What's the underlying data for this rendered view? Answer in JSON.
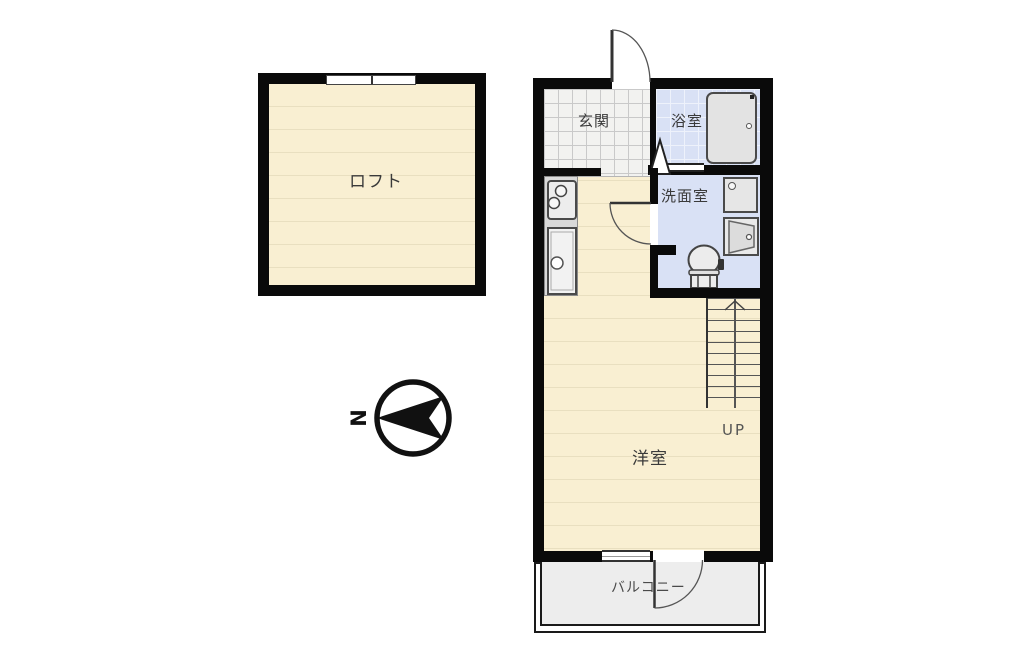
{
  "plan": {
    "title": "1R loft apartment floor plan",
    "compass": {
      "north_label": "N"
    },
    "labels": {
      "loft": "ロフト",
      "entrance": "玄関",
      "bathroom": "浴室",
      "washroom": "洗面室",
      "main_room": "洋室",
      "balcony": "バルコニー",
      "stairs_up": "UP"
    },
    "colors": {
      "wall": "#0a0a0a",
      "wood": "#f9efd2",
      "woodline": "#e9dfc0",
      "tile": "#f2f2f0",
      "tileline": "#c9c9c9",
      "wet": "#d9e1f5",
      "wetgrid": "#eef2fb",
      "balconyfloor": "#ededed",
      "fixture": "#e3e3e3",
      "counter": "#d9d9d9"
    }
  }
}
